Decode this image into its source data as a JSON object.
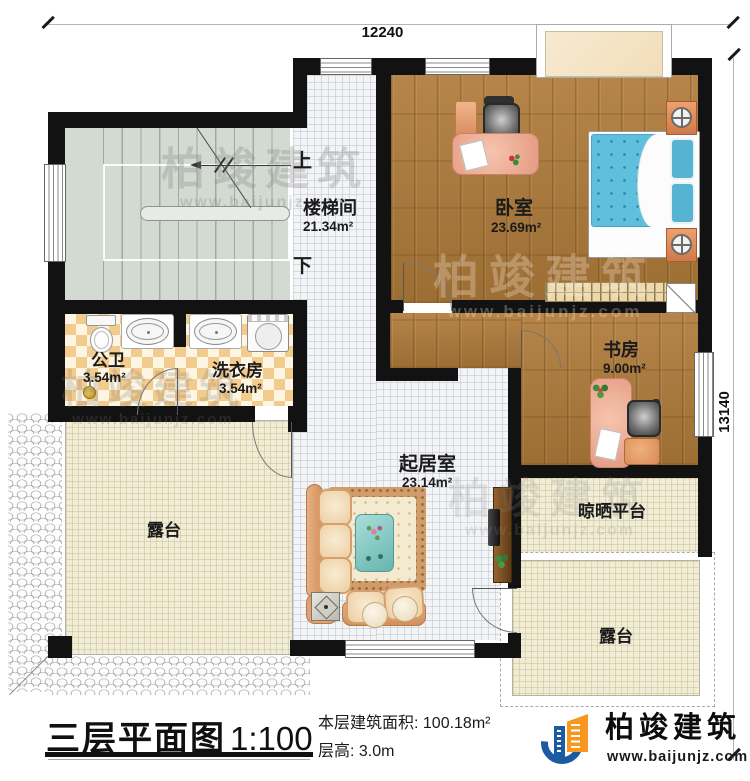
{
  "plan": {
    "dim_top": "12240",
    "dim_right": "13140",
    "stairs": {
      "up": "上",
      "down": "下"
    },
    "rooms": [
      {
        "name": "楼梯间",
        "area": "21.34m²"
      },
      {
        "name": "卧室",
        "area": "23.69m²"
      },
      {
        "name": "书房",
        "area": "9.00m²"
      },
      {
        "name": "公卫",
        "area": "3.54m²"
      },
      {
        "name": "洗衣房",
        "area": "3.54m²"
      },
      {
        "name": "起居室",
        "area": "23.14m²"
      },
      {
        "name": "晾晒平台"
      },
      {
        "name": "露台"
      },
      {
        "name": "露台"
      }
    ]
  },
  "titleblock": {
    "title": "三层平面图",
    "scale": "1:100",
    "area_line": "本层建筑面积: 100.18m²",
    "floor_height_line": "层高: 3.0m"
  },
  "brand": {
    "name": "柏竣建筑",
    "website": "www.baijunjz.com",
    "colors": {
      "blue": "#1c5ba4",
      "orange": "#f6981f"
    }
  },
  "watermark": {
    "text": "柏竣建筑",
    "website": "www.baijunjz.com"
  }
}
